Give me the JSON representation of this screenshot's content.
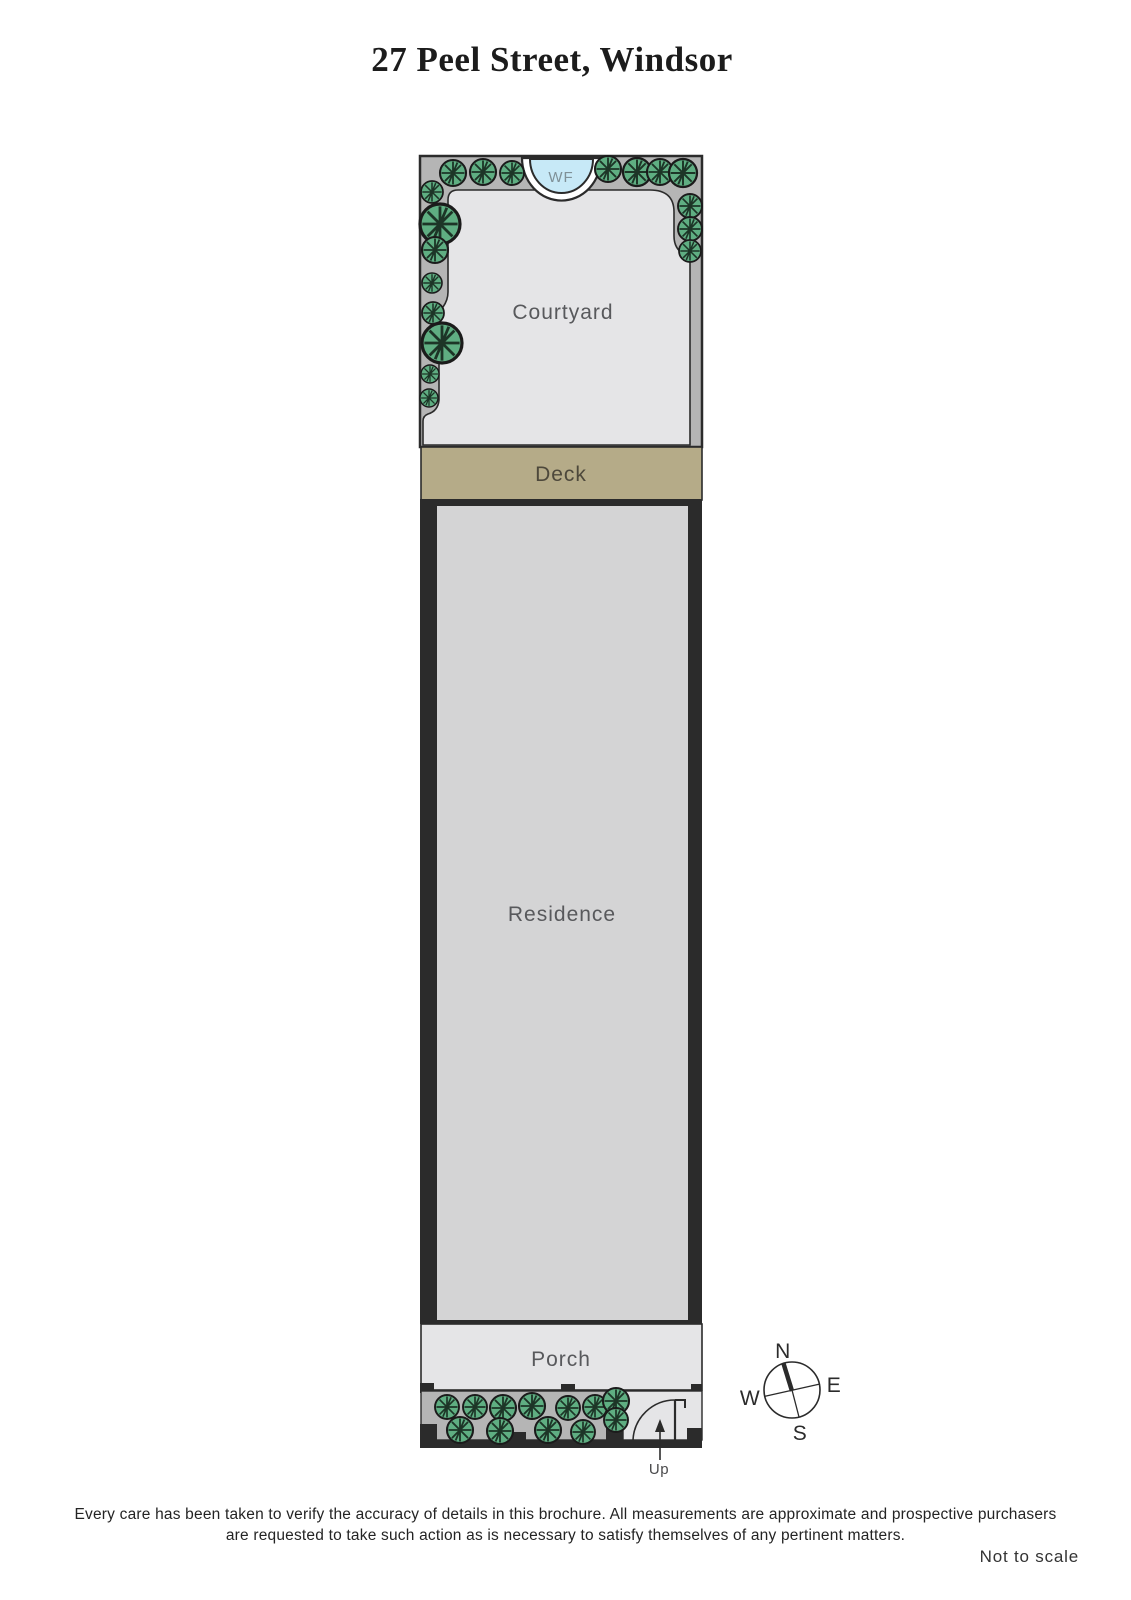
{
  "header": {
    "title": "27 Peel Street, Windsor"
  },
  "plan": {
    "labels": {
      "courtyard": "Courtyard",
      "deck": "Deck",
      "residence": "Residence",
      "porch": "Porch",
      "water_feature": "WF",
      "up": "Up"
    },
    "compass": {
      "north": "N",
      "east": "E",
      "south": "S",
      "west": "W"
    }
  },
  "colors": {
    "wall_black": "#2b2b2b",
    "garden_bed_gray": "#b5b5b5",
    "courtyard_fill": "#e5e5e7",
    "porch_fill": "#e5e5e7",
    "residence_fill": "#d4d4d5",
    "deck_tan": "#b5ab88",
    "tree_green": "#5fae82",
    "water_blue": "#c7e9f7",
    "label_gray": "#58595c"
  },
  "footer": {
    "disclaimer_line1": "Every care has been taken to verify the accuracy of details in this brochure.  All measurements are approximate and prospective purchasers",
    "disclaimer_line2": "are requested to take such action as is necessary to satisfy themselves of any pertinent matters.",
    "scale_note": "Not to scale"
  }
}
